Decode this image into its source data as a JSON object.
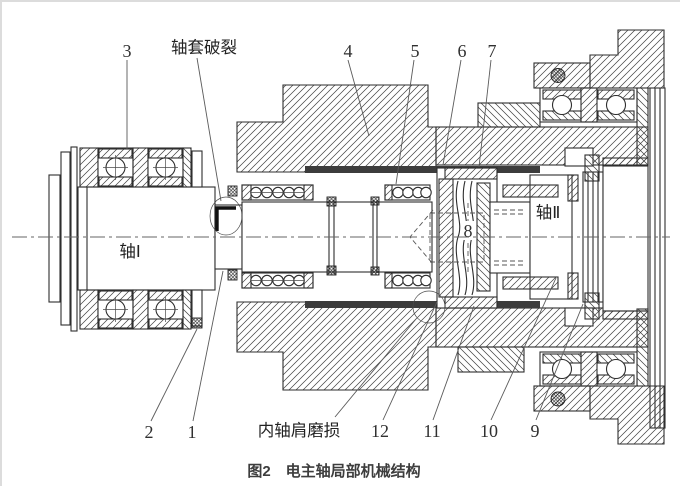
{
  "page": {
    "background": "#ffffff",
    "line_color": "#2e2e2e",
    "caption_color": "#3d3d3d"
  },
  "figure": {
    "caption": "图2　电主轴局部机械结构",
    "shaft_labels": {
      "shaft1": "轴Ⅰ",
      "shaft2": "轴Ⅱ"
    },
    "annotations": {
      "sleeve_crack": "轴套破裂",
      "inner_shoulder_wear": "内轴肩磨损"
    },
    "part_numbers": {
      "n1": "1",
      "n2": "2",
      "n3": "3",
      "n4": "4",
      "n5": "5",
      "n6": "6",
      "n7": "7",
      "n8": "8",
      "n9": "9",
      "n10": "10",
      "n11": "11",
      "n12": "12"
    }
  }
}
